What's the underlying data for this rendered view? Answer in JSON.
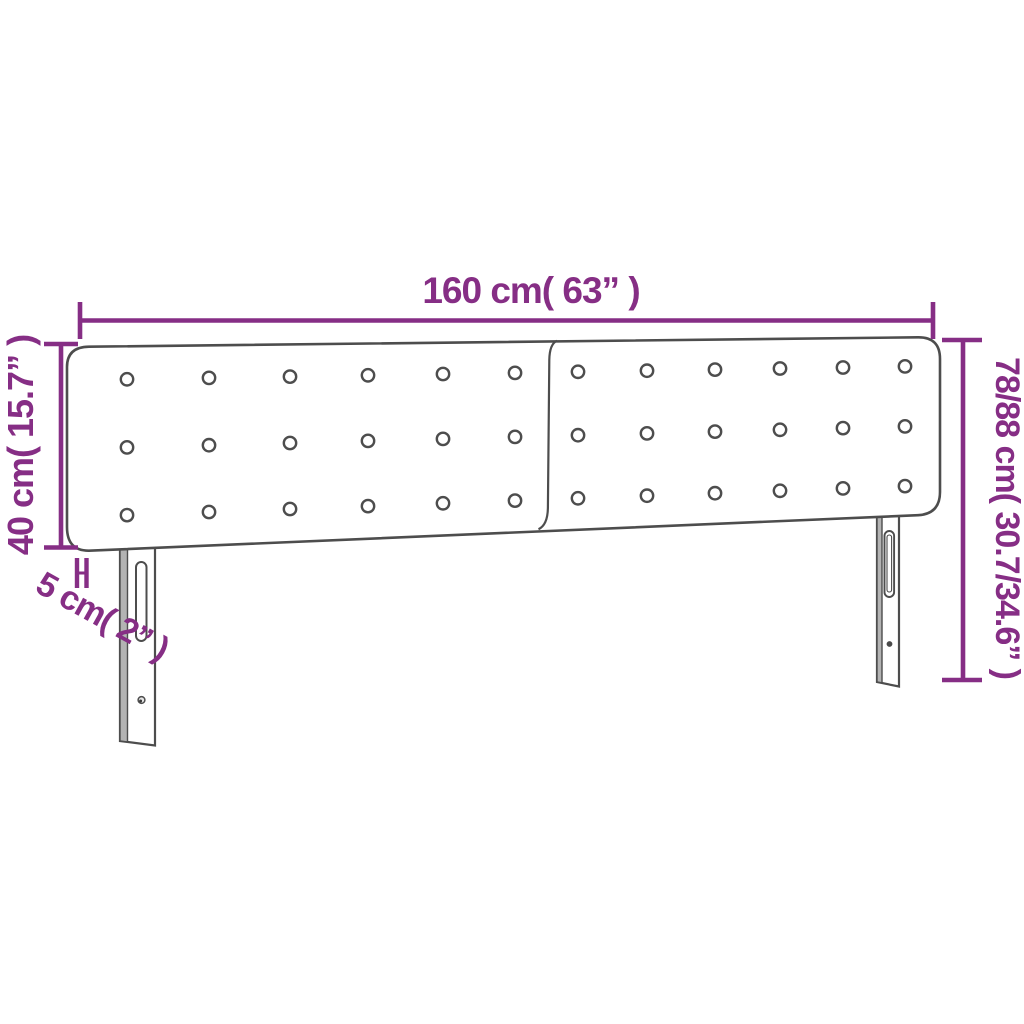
{
  "title": "Headboard dimension diagram",
  "dimensions": {
    "width_label": "160 cm( 63” )",
    "panel_height_label": "40 cm( 15.7” )",
    "depth_label": "5 cm( 2” )",
    "total_height_label": "78/88 cm( 30.7/34.6” )"
  },
  "colors": {
    "dimension_purple": "#862e85",
    "outline_gray": "#4d4d4d",
    "leg_shade_gray": "#b3b3b3",
    "background": "#ffffff"
  },
  "tufting": {
    "rows": 3,
    "cols_per_panel": 6,
    "panels": 2,
    "total_buttons": 36
  }
}
